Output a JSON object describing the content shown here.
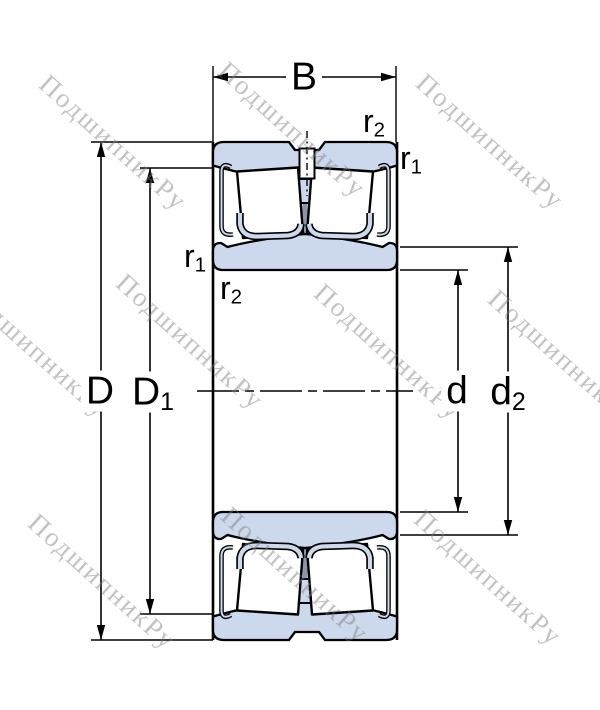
{
  "title": "spherical-roller-bearing-cross-section-drawing",
  "watermark": {
    "text": "ПодшипникРу",
    "color_hex": "#c6c6c6"
  },
  "labels": {
    "width": {
      "base": "B",
      "sub": ""
    },
    "outer_diameter": {
      "base": "D",
      "sub": ""
    },
    "outer_land_diameter": {
      "base": "D",
      "sub": "1"
    },
    "bore_diameter": {
      "base": "d",
      "sub": ""
    },
    "inner_land_diameter": {
      "base": "d",
      "sub": "2"
    },
    "chamfer_top_r2": {
      "base": "r",
      "sub": "2"
    },
    "chamfer_top_r1": {
      "base": "r",
      "sub": "1"
    },
    "chamfer_left_r1": {
      "base": "r",
      "sub": "1"
    },
    "chamfer_left_r2": {
      "base": "r",
      "sub": "2"
    }
  },
  "colors": {
    "ring_fill": "#ccd8ec",
    "outline": "#000000",
    "cage_stem": "#8c96aa",
    "background": "#ffffff"
  }
}
